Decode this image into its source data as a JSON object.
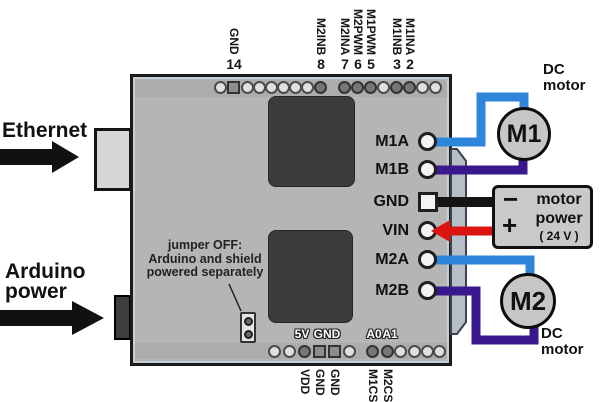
{
  "colors": {
    "board_gray": "#b5b5b5",
    "chip_gray": "#3b3b3b",
    "wire_blue": "#2e86db",
    "wire_purple": "#38188c",
    "wire_black": "#141414",
    "wire_red": "#dc1410",
    "pcb_tab": "#b6bfc8"
  },
  "left": {
    "ethernet_label": "Ethernet",
    "power_label_line1": "Arduino",
    "power_label_line2": "power"
  },
  "jumper_note": {
    "line1": "jumper OFF:",
    "line2": "Arduino and shield",
    "line3": "powered separately"
  },
  "top_header": {
    "pins": [
      {
        "name": "GND",
        "num": "14"
      },
      {
        "name": "M2INB",
        "num": "8"
      },
      {
        "name": "M2INA",
        "num": "7"
      },
      {
        "name": "M2PWM",
        "num": "6"
      },
      {
        "name": "M1PWM",
        "num": "5"
      },
      {
        "name": "M1INB",
        "num": "3"
      },
      {
        "name": "M1INA",
        "num": "2"
      }
    ]
  },
  "bottom_header": {
    "board_labels": [
      {
        "text": "5V"
      },
      {
        "text": "GND"
      },
      {
        "text": "A0"
      },
      {
        "text": "A1"
      }
    ],
    "below_labels": [
      {
        "text": "VDD"
      },
      {
        "text": "GND"
      },
      {
        "text": "GND"
      },
      {
        "text": "M1CS"
      },
      {
        "text": "M2CS"
      }
    ]
  },
  "right_pins": [
    {
      "label": "M1A"
    },
    {
      "label": "M1B"
    },
    {
      "label": "GND"
    },
    {
      "label": "VIN"
    },
    {
      "label": "M2A"
    },
    {
      "label": "M2B"
    }
  ],
  "motor1": {
    "label": "M1",
    "caption_line1": "DC",
    "caption_line2": "motor"
  },
  "motor2": {
    "label": "M2",
    "caption_line1": "DC",
    "caption_line2": "motor"
  },
  "power_box": {
    "minus": "−",
    "plus": "+",
    "line1": "motor",
    "line2": "power",
    "line3": "( 24 V )"
  }
}
